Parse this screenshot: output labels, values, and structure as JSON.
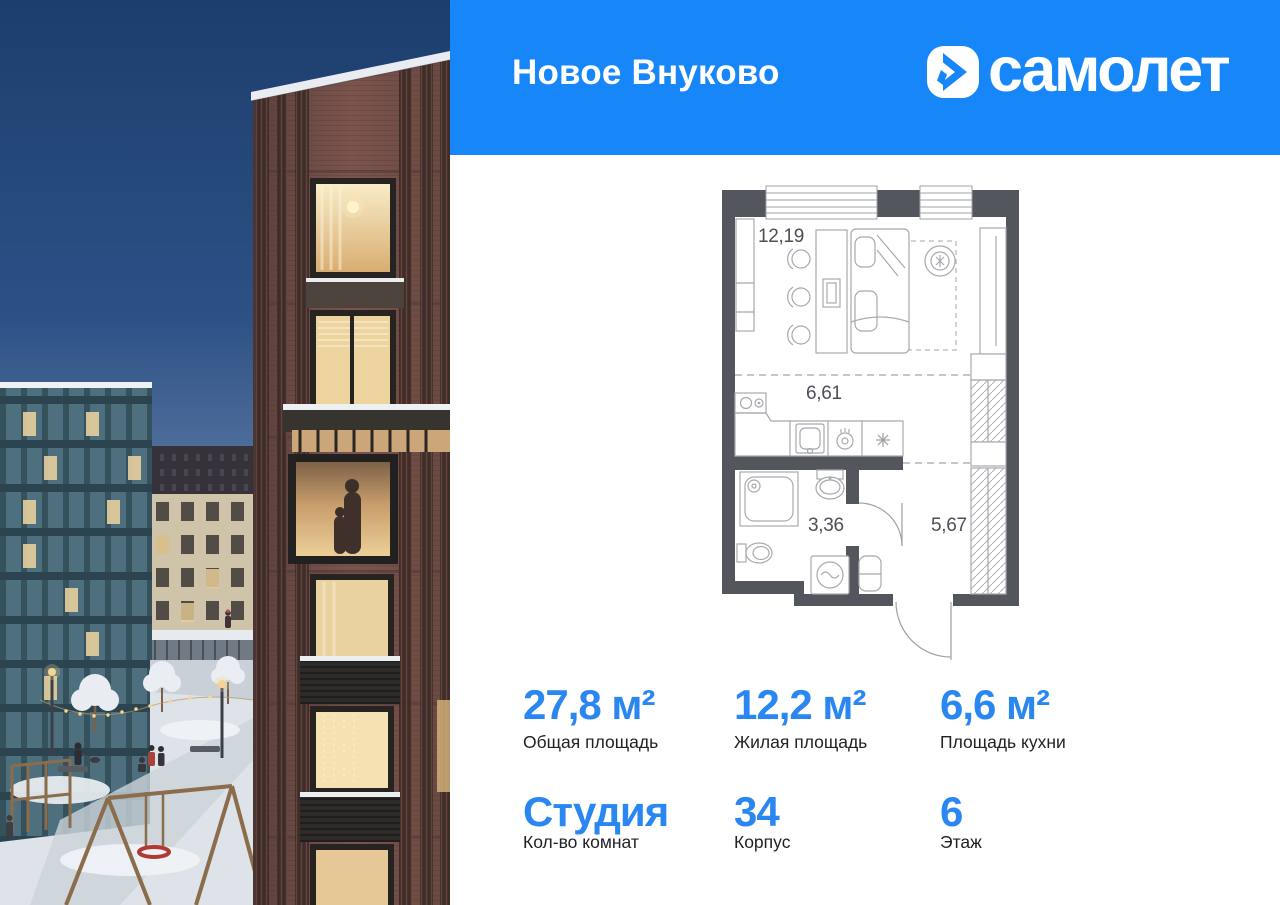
{
  "colors": {
    "header_bg": "#1786F8",
    "accent_blue": "#2A87F1",
    "plan_wall": "#54565E",
    "plan_line": "#A7A9AE"
  },
  "header": {
    "project_name": "Новое Внуково",
    "brand_name": "самолет"
  },
  "floor_plan": {
    "living": "12,19",
    "kitchen": "6,61",
    "bathroom": "3,36",
    "hallway": "5,67"
  },
  "stats": {
    "row1": [
      {
        "value": "27,8 м²",
        "label": "Общая площадь"
      },
      {
        "value": "12,2 м²",
        "label": "Жилая площадь"
      },
      {
        "value": "6,6 м²",
        "label": "Площадь кухни"
      }
    ],
    "row2": [
      {
        "value": "Студия",
        "label": "Кол-во комнат"
      },
      {
        "value": "34",
        "label": "Корпус"
      },
      {
        "value": "6",
        "label": "Этаж"
      }
    ]
  }
}
